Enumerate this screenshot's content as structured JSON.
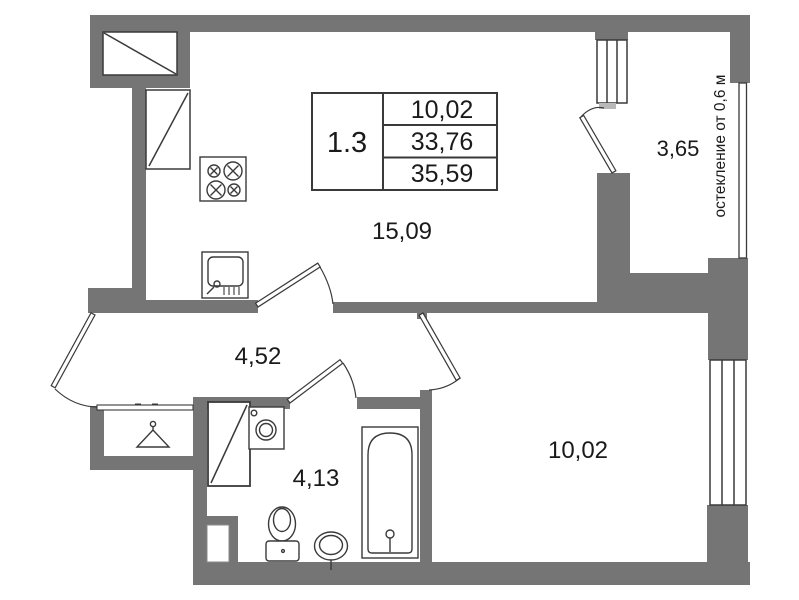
{
  "colors": {
    "wall": "#757575",
    "line": "#3a3a3a",
    "text": "#1a1a1a"
  },
  "stamp": {
    "unit": "1.3",
    "rows": [
      "10,02",
      "33,76",
      "35,59"
    ]
  },
  "rooms": {
    "living_kitchen": "15,09",
    "hallway": "4,52",
    "bathroom": "4,13",
    "bedroom": "10,02",
    "balcony": "3,65"
  },
  "notes": {
    "glazing": "остекление от 0,6 м"
  }
}
